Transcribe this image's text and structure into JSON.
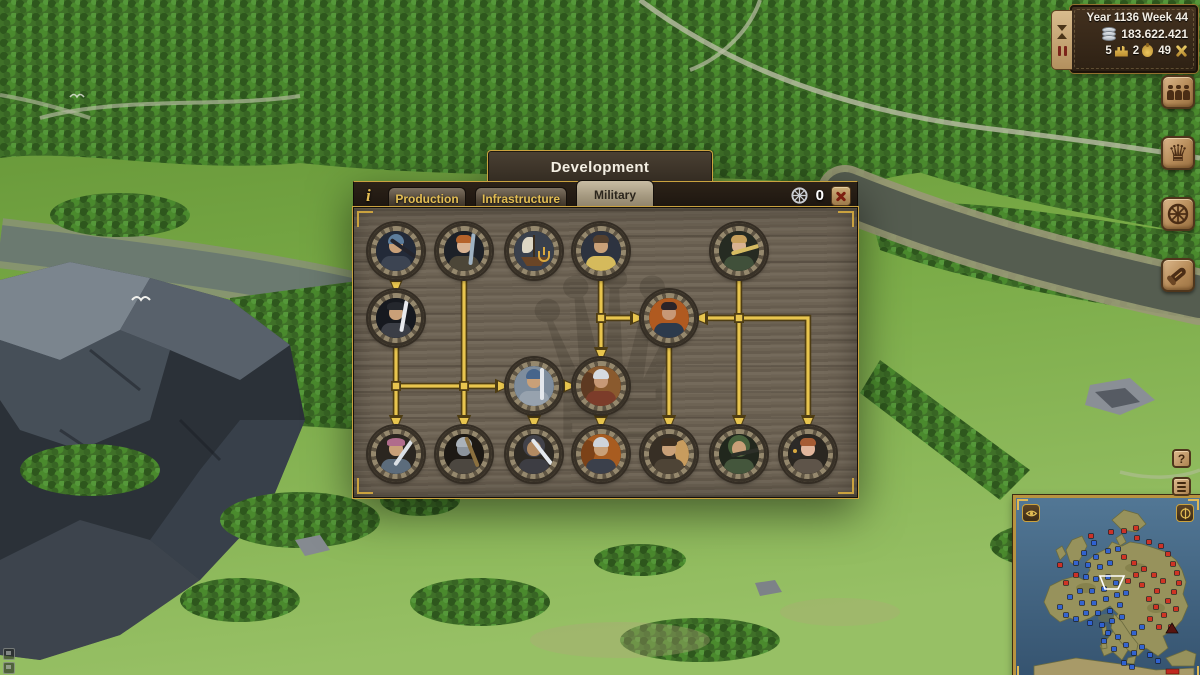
{
  "hud": {
    "date": "Year 1136 Week 44",
    "treasury": "183.622.421",
    "stats": [
      {
        "value": "5",
        "icon": "settlement-icon"
      },
      {
        "value": "2",
        "icon": "goods-bag-icon"
      },
      {
        "value": "49",
        "icon": "military-icon"
      }
    ]
  },
  "panel": {
    "title": "Development",
    "info_icon": "i",
    "tabs": [
      {
        "id": "production",
        "label": "Production",
        "active": false
      },
      {
        "id": "infrastructure",
        "label": "Infrastructure",
        "active": false
      },
      {
        "id": "military",
        "label": "Military",
        "active": true
      }
    ],
    "research_points": "0",
    "close_label": "x"
  },
  "tech_tree": {
    "cols": [
      42,
      110,
      180,
      247,
      315,
      385,
      454
    ],
    "rows": [
      43,
      110,
      178,
      246
    ],
    "node_radius": 28,
    "line_color": "#e8c54e",
    "line_shadow": "#4e3d14",
    "nodes": [
      {
        "id": "warhammer-infantry",
        "col": 1,
        "row": 1,
        "p": {
          "bg": "#232a38",
          "cloth": "#3c4452",
          "skin": "#c9a078",
          "hat": "helmet",
          "hatc": "#5d7d9c",
          "wpn": "#23242c",
          "wang": -55
        }
      },
      {
        "id": "bardiche-infantry",
        "col": 2,
        "row": 1,
        "p": {
          "bg": "#1d2128",
          "cloth": "#4c4638",
          "skin": "#d8b292",
          "hair": "#b5622a",
          "wpn": "#9fb2c2",
          "wang": 6
        }
      },
      {
        "id": "warship",
        "col": 3,
        "row": 1,
        "p": {
          "type": "ship",
          "bg": "#39404c"
        }
      },
      {
        "id": "scouting",
        "col": 4,
        "row": 1,
        "p": {
          "bg": "#2d3340",
          "cloth": "#d5ba5c",
          "skin": "#c9a078",
          "hair": "#54402e"
        }
      },
      {
        "id": "longbowman",
        "col": 6,
        "row": 1,
        "p": {
          "bg": "#262b22",
          "cloth": "#40503a",
          "skin": "#d8b292",
          "hair": "#c7a05c",
          "wpn": "#d6bc62",
          "wang": 74
        }
      },
      {
        "id": "poleaxe-infantry",
        "col": 1,
        "row": 2,
        "p": {
          "bg": "#16191f",
          "cloth": "#3b3e46",
          "skin": "#c9a078",
          "hat": "cap",
          "hatc": "#24272d",
          "wpn": "#e8eaee",
          "wang": 10
        }
      },
      {
        "id": "commander",
        "col": 5,
        "row": 2,
        "p": {
          "bg": "#b05a20",
          "cloth": "#2c3a4c",
          "skin": "#c79876",
          "hair": "#2c2428"
        }
      },
      {
        "id": "swordsman",
        "col": 3,
        "row": 3,
        "p": {
          "bg": "#7e8d9d",
          "cloth": "#97a2ae",
          "skin": "#c9a078",
          "hat": "helmet",
          "hatc": "#47658b",
          "wpn": "#e3e7ec",
          "wang": 0
        }
      },
      {
        "id": "light-cavalry",
        "col": 4,
        "row": 3,
        "p": {
          "bg": "#8a5a2e",
          "cloth": "#7c3c2a",
          "skin": "#c79876",
          "hat": "helmet",
          "hatc": "#d6dae0",
          "extra": "horse-l",
          "extrac": "#5e3a22"
        }
      },
      {
        "id": "axe-militia",
        "col": 1,
        "row": 4,
        "p": {
          "bg": "#2b2620",
          "cloth": "#5c6c7c",
          "skin": "#c9a078",
          "hat": "cap",
          "hatc": "#b06c8c",
          "wpn": "#dbe0e5",
          "wang": 35
        }
      },
      {
        "id": "mace-knight",
        "col": 2,
        "row": 4,
        "p": {
          "bg": "#1d1914",
          "cloth": "#4c4740",
          "skin": "#8b939c",
          "hat": "helmet",
          "hatc": "#aab2ba",
          "wpn": "#8b703f",
          "wang": -22
        }
      },
      {
        "id": "falchion-infantry",
        "col": 3,
        "row": 4,
        "p": {
          "bg": "#2d2923",
          "cloth": "#3d3d43",
          "skin": "#b28a62",
          "hat": "hood",
          "hatc": "#42424a",
          "wpn": "#e4e8ec",
          "wang": -38
        }
      },
      {
        "id": "knight",
        "col": 4,
        "row": 4,
        "p": {
          "bg": "#a85c20",
          "cloth": "#3b404b",
          "skin": "#c9a078",
          "hat": "helmet",
          "hatc": "#ced3da",
          "extra": "horse-l",
          "extrac": "#7c4218"
        }
      },
      {
        "id": "mounted-scout",
        "col": 5,
        "row": 4,
        "p": {
          "bg": "#372f25",
          "cloth": "#4e4436",
          "skin": "#c9a078",
          "hair": "#3c2e20",
          "extra": "horse-r",
          "extrac": "#c89c5e"
        }
      },
      {
        "id": "crossbowman",
        "col": 6,
        "row": 4,
        "p": {
          "bg": "#21271d",
          "cloth": "#44563c",
          "skin": "#c9a078",
          "hat": "hood",
          "hatc": "#47613b",
          "wpn": "#2c2f28",
          "wang": 78
        }
      },
      {
        "id": "falconer",
        "col": 7,
        "row": 4,
        "p": {
          "bg": "#2b2721",
          "cloth": "#5e5449",
          "skin": "#e2b69c",
          "hair": "#a65c34",
          "extra": "falcon",
          "extrac": "#2c2a28"
        }
      }
    ],
    "edges": [
      {
        "pts": [
          [
            1,
            1
          ],
          [
            1,
            2
          ]
        ]
      },
      {
        "pts": [
          [
            1,
            2
          ],
          [
            1,
            4
          ]
        ]
      },
      {
        "pts": [
          [
            1,
            3
          ],
          [
            3,
            3
          ]
        ]
      },
      {
        "pts": [
          [
            2,
            1
          ],
          [
            2,
            4
          ]
        ]
      },
      {
        "pts": [
          [
            3,
            3
          ],
          [
            4,
            3
          ]
        ]
      },
      {
        "pts": [
          [
            4,
            1
          ],
          [
            4,
            3
          ]
        ]
      },
      {
        "pts": [
          [
            4,
            2
          ],
          [
            5,
            2
          ]
        ]
      },
      {
        "pts": [
          [
            6,
            2
          ],
          [
            5,
            2
          ]
        ]
      },
      {
        "pts": [
          [
            3,
            3
          ],
          [
            3,
            4
          ]
        ]
      },
      {
        "pts": [
          [
            4,
            3
          ],
          [
            4,
            4
          ]
        ]
      },
      {
        "pts": [
          [
            5,
            2
          ],
          [
            5,
            4
          ]
        ]
      },
      {
        "pts": [
          [
            6,
            1
          ],
          [
            6,
            4
          ]
        ]
      },
      {
        "pts": [
          [
            6,
            2
          ],
          [
            7,
            2
          ],
          [
            7,
            4
          ]
        ]
      }
    ],
    "junctions": [
      [
        1,
        3
      ],
      [
        2,
        3
      ],
      [
        4,
        2
      ],
      [
        6,
        2
      ]
    ]
  },
  "side_buttons": [
    {
      "id": "population",
      "icon": "people-icon"
    },
    {
      "id": "kingdom",
      "icon": "crown-icon",
      "glyph": "♛"
    },
    {
      "id": "trade",
      "icon": "wheel-icon"
    },
    {
      "id": "messages",
      "icon": "scroll-icon"
    }
  ],
  "corner_buttons": {
    "help": "?",
    "menu_icon": "menu-bars-icon"
  },
  "minimap": {
    "marker_colors": {
      "b": "#2f62d6",
      "r": "#d22f22"
    },
    "markers": [
      [
        95,
        34,
        "r"
      ],
      [
        108,
        33,
        "r"
      ],
      [
        120,
        30,
        "r"
      ],
      [
        121,
        40,
        "r"
      ],
      [
        133,
        44,
        "r"
      ],
      [
        145,
        48,
        "r"
      ],
      [
        152,
        56,
        "r"
      ],
      [
        157,
        66,
        "r"
      ],
      [
        161,
        75,
        "r"
      ],
      [
        163,
        85,
        "r"
      ],
      [
        158,
        94,
        "r"
      ],
      [
        152,
        103,
        "r"
      ],
      [
        160,
        111,
        "r"
      ],
      [
        148,
        117,
        "r"
      ],
      [
        140,
        109,
        "r"
      ],
      [
        133,
        101,
        "r"
      ],
      [
        141,
        93,
        "r"
      ],
      [
        147,
        83,
        "r"
      ],
      [
        138,
        77,
        "r"
      ],
      [
        128,
        71,
        "r"
      ],
      [
        118,
        65,
        "r"
      ],
      [
        108,
        59,
        "r"
      ],
      [
        120,
        77,
        "r"
      ],
      [
        112,
        83,
        "r"
      ],
      [
        126,
        87,
        "r"
      ],
      [
        134,
        121,
        "r"
      ],
      [
        143,
        129,
        "r"
      ],
      [
        155,
        129,
        "r"
      ],
      [
        60,
        77,
        "r"
      ],
      [
        50,
        85,
        "r"
      ],
      [
        44,
        67,
        "r"
      ],
      [
        75,
        38,
        "r"
      ],
      [
        78,
        45,
        "b"
      ],
      [
        68,
        55,
        "b"
      ],
      [
        80,
        59,
        "b"
      ],
      [
        92,
        53,
        "b"
      ],
      [
        102,
        51,
        "b"
      ],
      [
        60,
        65,
        "b"
      ],
      [
        72,
        67,
        "b"
      ],
      [
        84,
        69,
        "b"
      ],
      [
        94,
        65,
        "b"
      ],
      [
        70,
        79,
        "b"
      ],
      [
        80,
        81,
        "b"
      ],
      [
        92,
        79,
        "b"
      ],
      [
        100,
        85,
        "b"
      ],
      [
        88,
        91,
        "b"
      ],
      [
        76,
        93,
        "b"
      ],
      [
        64,
        93,
        "b"
      ],
      [
        54,
        99,
        "b"
      ],
      [
        66,
        105,
        "b"
      ],
      [
        78,
        105,
        "b"
      ],
      [
        90,
        101,
        "b"
      ],
      [
        101,
        97,
        "b"
      ],
      [
        110,
        95,
        "b"
      ],
      [
        70,
        115,
        "b"
      ],
      [
        82,
        115,
        "b"
      ],
      [
        94,
        113,
        "b"
      ],
      [
        104,
        107,
        "b"
      ],
      [
        60,
        121,
        "b"
      ],
      [
        74,
        125,
        "b"
      ],
      [
        86,
        127,
        "b"
      ],
      [
        96,
        123,
        "b"
      ],
      [
        106,
        119,
        "b"
      ],
      [
        92,
        135,
        "b"
      ],
      [
        102,
        139,
        "b"
      ],
      [
        110,
        147,
        "b"
      ],
      [
        118,
        155,
        "b"
      ],
      [
        126,
        149,
        "b"
      ],
      [
        134,
        157,
        "b"
      ],
      [
        142,
        163,
        "b"
      ],
      [
        118,
        135,
        "b"
      ],
      [
        126,
        129,
        "b"
      ],
      [
        98,
        151,
        "b"
      ],
      [
        88,
        143,
        "b"
      ],
      [
        44,
        109,
        "b"
      ],
      [
        50,
        117,
        "b"
      ],
      [
        108,
        165,
        "b"
      ],
      [
        116,
        169,
        "b"
      ]
    ],
    "player_marker": [
      156,
      131
    ],
    "viewport": [
      84,
      78,
      108,
      78,
      102,
      91,
      89,
      91
    ],
    "badge": [
      150,
      171
    ]
  }
}
